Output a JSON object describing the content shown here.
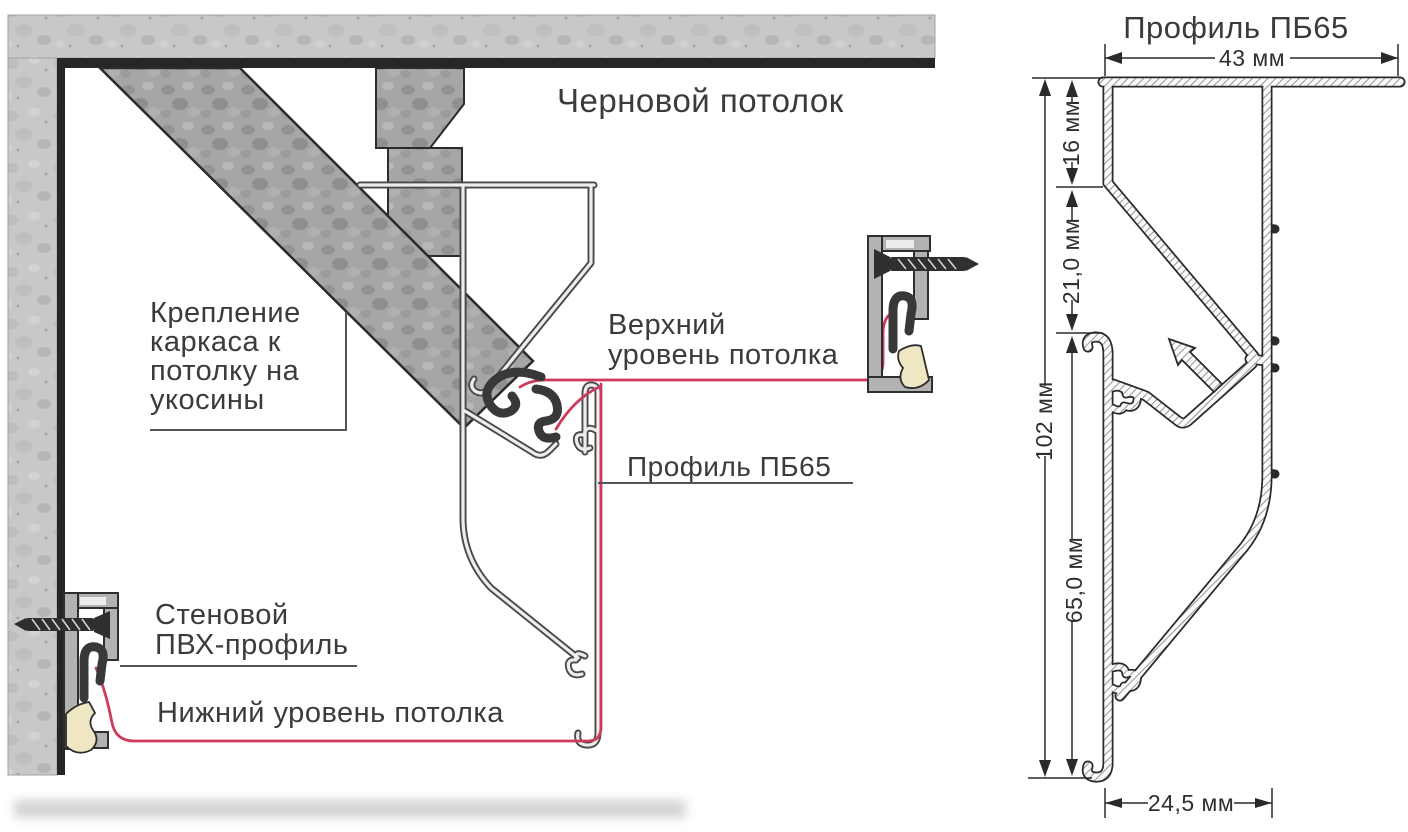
{
  "colors": {
    "membrane_red": "#cd3a5c",
    "concrete_gray": "#c8c8c8",
    "steel_gray": "#a6a6a6",
    "line_dark": "#2a2a2a",
    "profile_outline": "#4a4a4a",
    "harpoon_dark": "#383838",
    "insert_cream": "#efe6c3",
    "text_color": "#3b3b3b"
  },
  "installation_diagram": {
    "rough_ceiling": "Черновой потолок",
    "frame_mount": [
      "Крепление",
      "каркаса к",
      "потолку на",
      "укосины"
    ],
    "upper_level": [
      "Верхний",
      "уровень потолка"
    ],
    "profile_callout": "Профиль ПБ65",
    "wall_profile": [
      "Стеновой",
      "ПВХ-профиль"
    ],
    "lower_level": "Нижний уровень потолка"
  },
  "profile_drawing": {
    "title": "Профиль ПБ65",
    "dimensions": {
      "top_width": "43 мм",
      "upper_height": "16 мм",
      "middle_height": "21,0 мм",
      "total_height": "102 мм",
      "lower_height": "65,0 мм",
      "bottom_width": "24,5 мм"
    }
  }
}
